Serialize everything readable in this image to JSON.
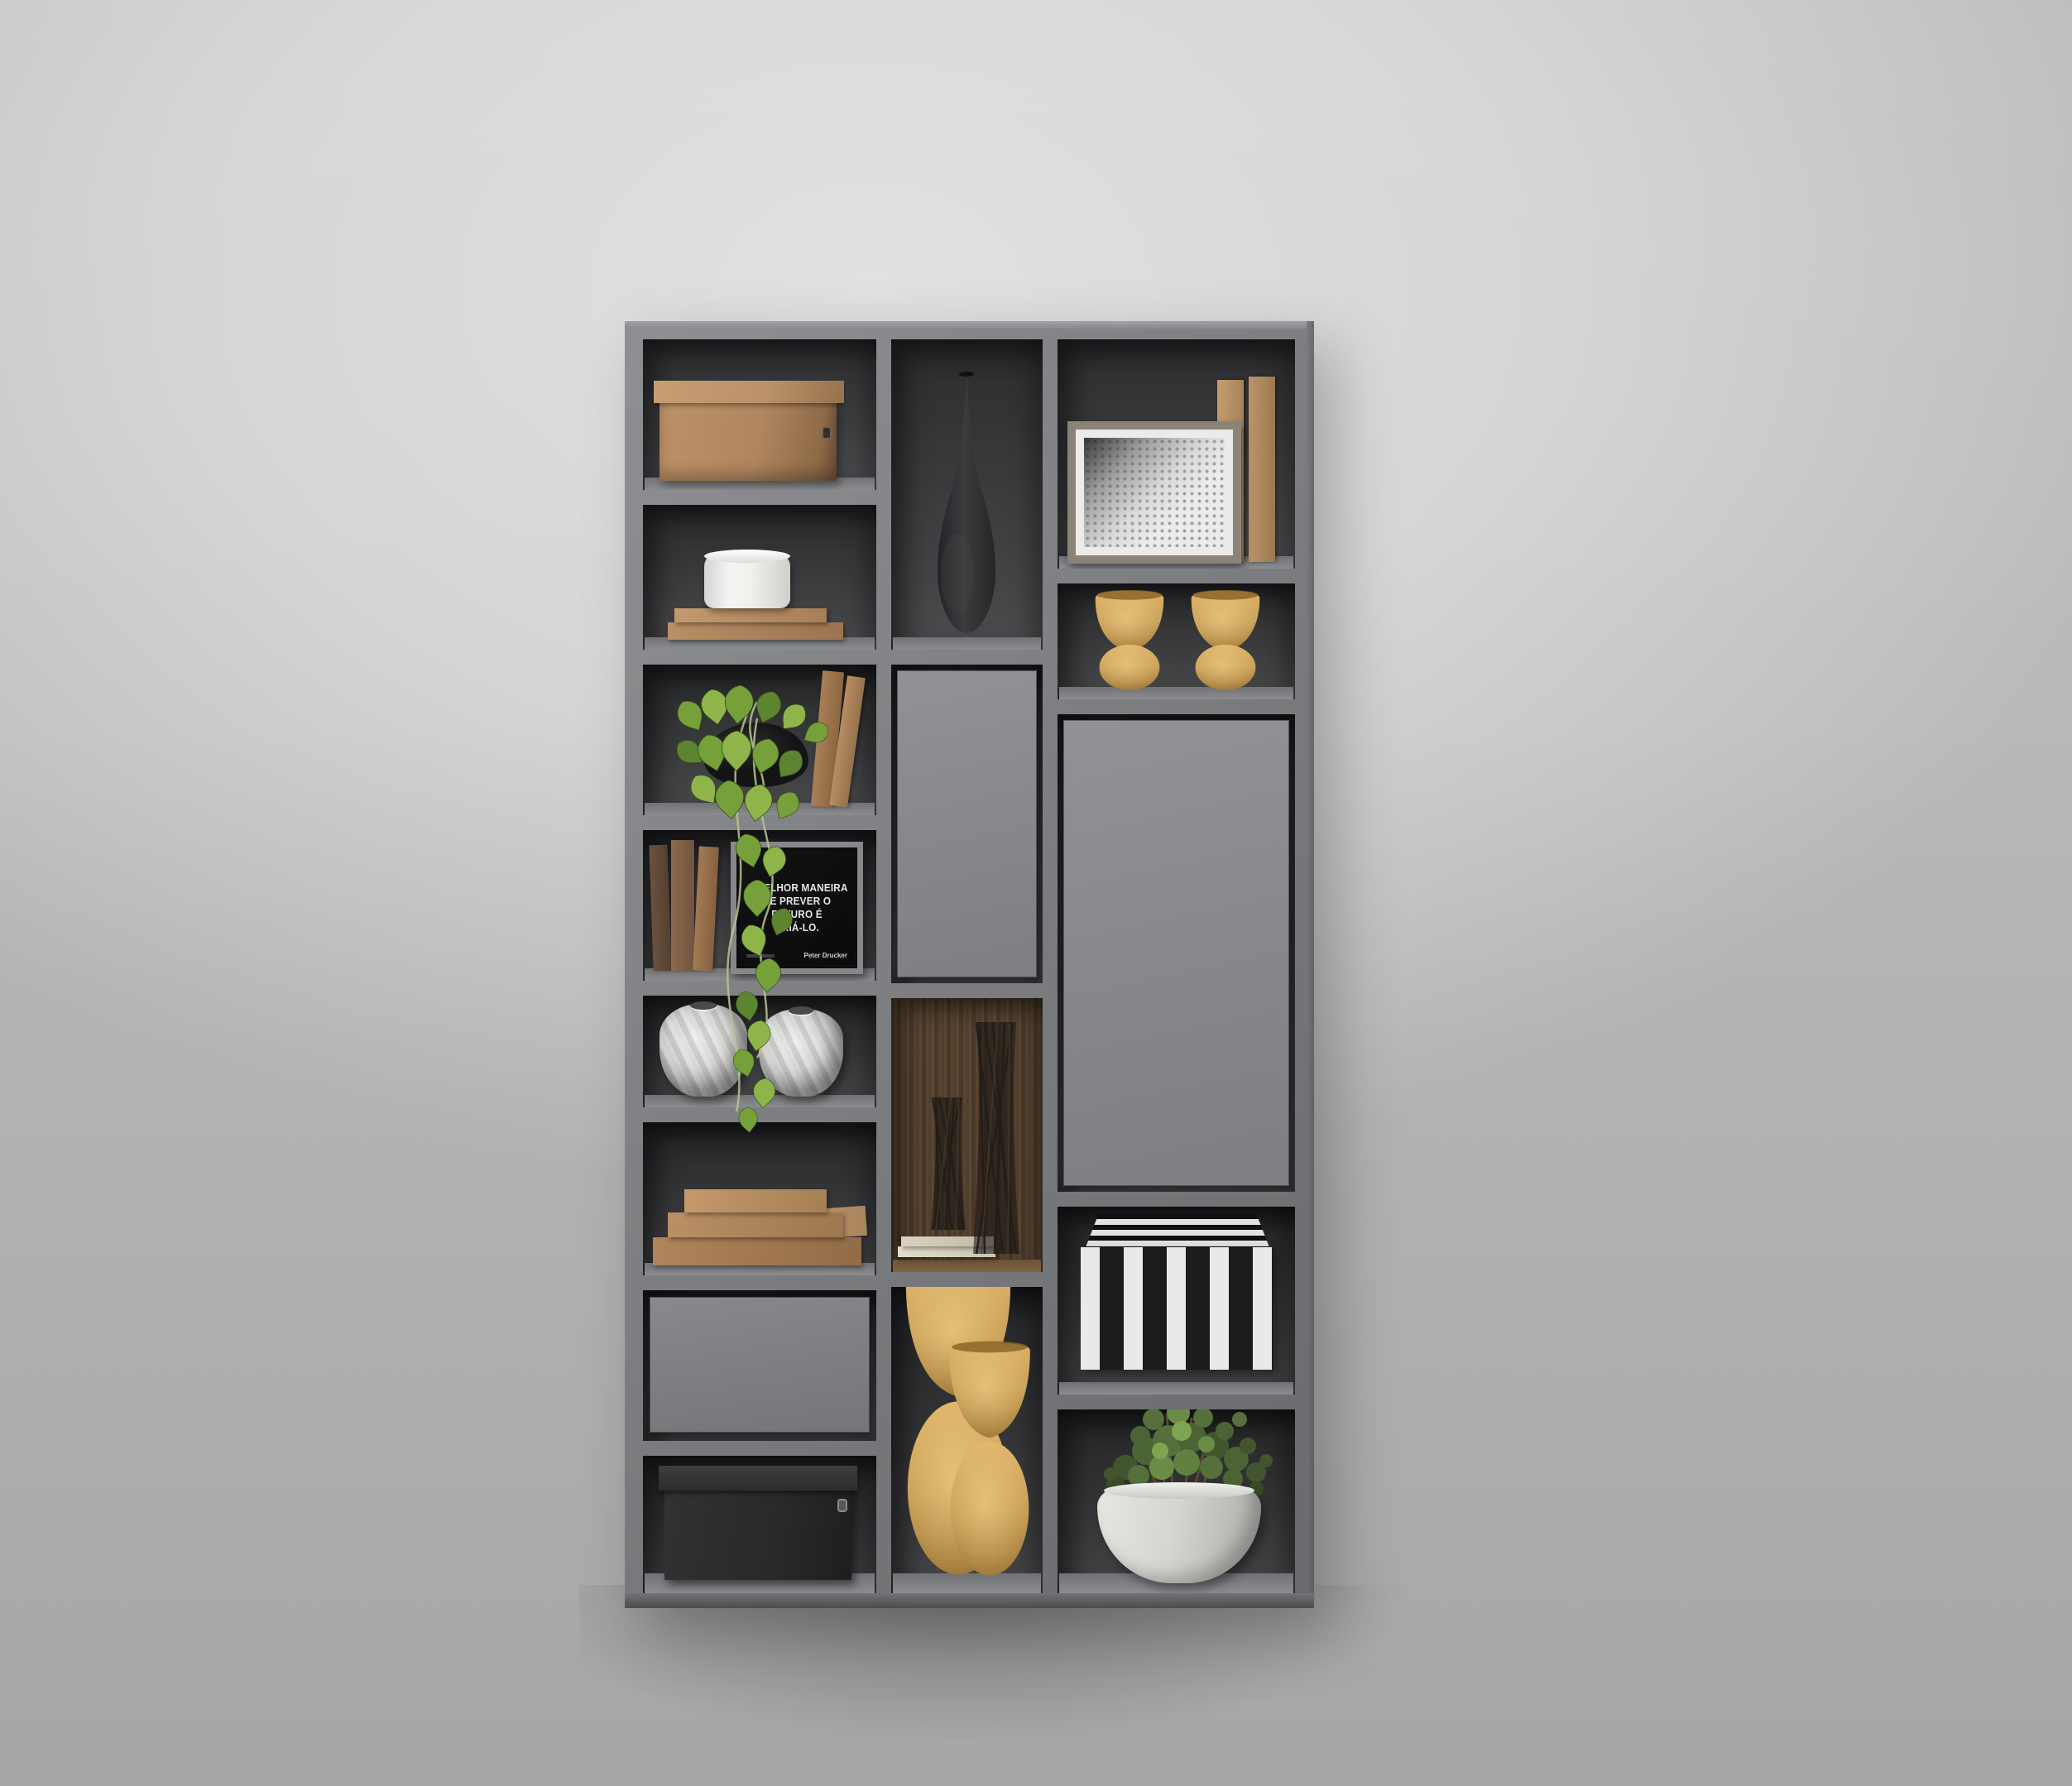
{
  "scene": {
    "type": "3d interior render",
    "subject": "wall-mounted gray shelving unit with decorative objects",
    "background": "plain light gray wall"
  },
  "quote_frame": {
    "line1": "A MELHOR MANEIRA",
    "line2": "DE PREVER O FUTURO É",
    "line3": "CRIÁ-LO.",
    "attribution": "Peter Drucker"
  },
  "items": [
    {
      "id": "l1",
      "name": "tan leather storage box with lid"
    },
    {
      "id": "l2",
      "name": "white round box on two stacked tan books"
    },
    {
      "id": "l3",
      "name": "hanging pothos plant in black pot with two leaning books"
    },
    {
      "id": "l4",
      "name": "standing books and black framed quote"
    },
    {
      "id": "l5",
      "name": "two white swirl ceramic vases"
    },
    {
      "id": "l6",
      "name": "pyramid stack of brown books"
    },
    {
      "id": "l7",
      "name": "gray drawer front"
    },
    {
      "id": "l8",
      "name": "black storage box with lid"
    },
    {
      "id": "m1",
      "name": "black teardrop bottle vase"
    },
    {
      "id": "m2",
      "name": "gray cabinet door"
    },
    {
      "id": "m3",
      "name": "walnut niche with two twig vases and cream books"
    },
    {
      "id": "m4",
      "name": "two tall gold hourglass vases"
    },
    {
      "id": "r1",
      "name": "framed dotted artwork with two vertical books"
    },
    {
      "id": "r2",
      "name": "two small gold goblet vessels"
    },
    {
      "id": "r3",
      "name": "tall gray cabinet door"
    },
    {
      "id": "r4",
      "name": "black and white striped box"
    },
    {
      "id": "r5",
      "name": "green shrub in round white pot"
    }
  ],
  "palette": {
    "wall1": "#e0e0e0",
    "wall2": "#b9b9b9",
    "frame": "#7f8184",
    "frame-light": "#9d9ea1",
    "frame-dark": "#5f6164",
    "interior-dark": "#1f2022",
    "interior-mid": "#434446",
    "door": "#87898c",
    "wood": "#55422f",
    "tan": "#b08660",
    "tan-light": "#c79d72",
    "tan-dark": "#8e6a47",
    "gold": "#c9a055",
    "gold-dark": "#9e7736",
    "white-item": "#e9e9e7",
    "black-item": "#28292b",
    "leaf": "#76a039",
    "leaf-light": "#a9c75d",
    "leaf-dark": "#55732c",
    "quote-bg": "#0d0d0d",
    "quote-text": "#e6e6e6",
    "pot": "#d6d6d1"
  }
}
